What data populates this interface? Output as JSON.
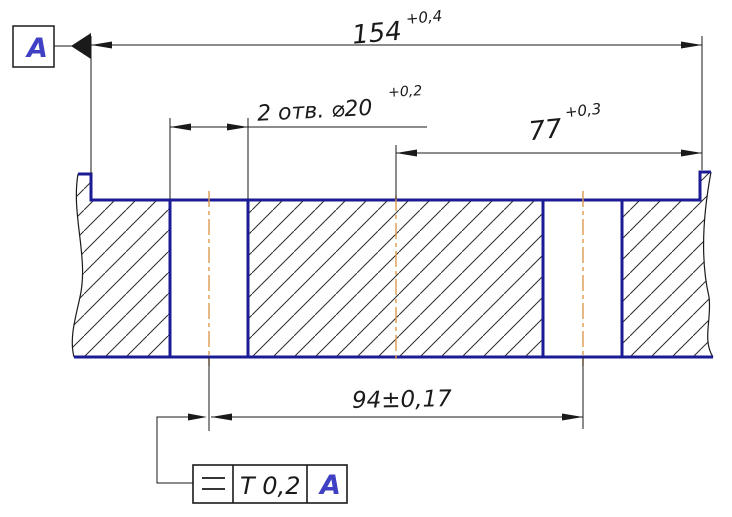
{
  "datum": {
    "label": "A"
  },
  "dimensions": {
    "overall_length": {
      "value": "154",
      "tolerance": "+0,4"
    },
    "holes_note": {
      "label": "2 отв. ⌀20",
      "tolerance": "+0,2"
    },
    "right_half": {
      "value": "77",
      "tolerance": "+0,3"
    },
    "hole_centers": {
      "value": "94±0,17"
    }
  },
  "tolerance_frame": {
    "symbol_icon": "parallelism-icon",
    "value": "T 0,2",
    "datum_ref": "A"
  },
  "colors": {
    "outline": "#1b1b96",
    "centerline": "#dd9b4f",
    "datum_text": "#4040c4",
    "hatch_line": "#2b2b2b",
    "dimension_line": "#1a1a1a",
    "background": "#ffffff"
  }
}
